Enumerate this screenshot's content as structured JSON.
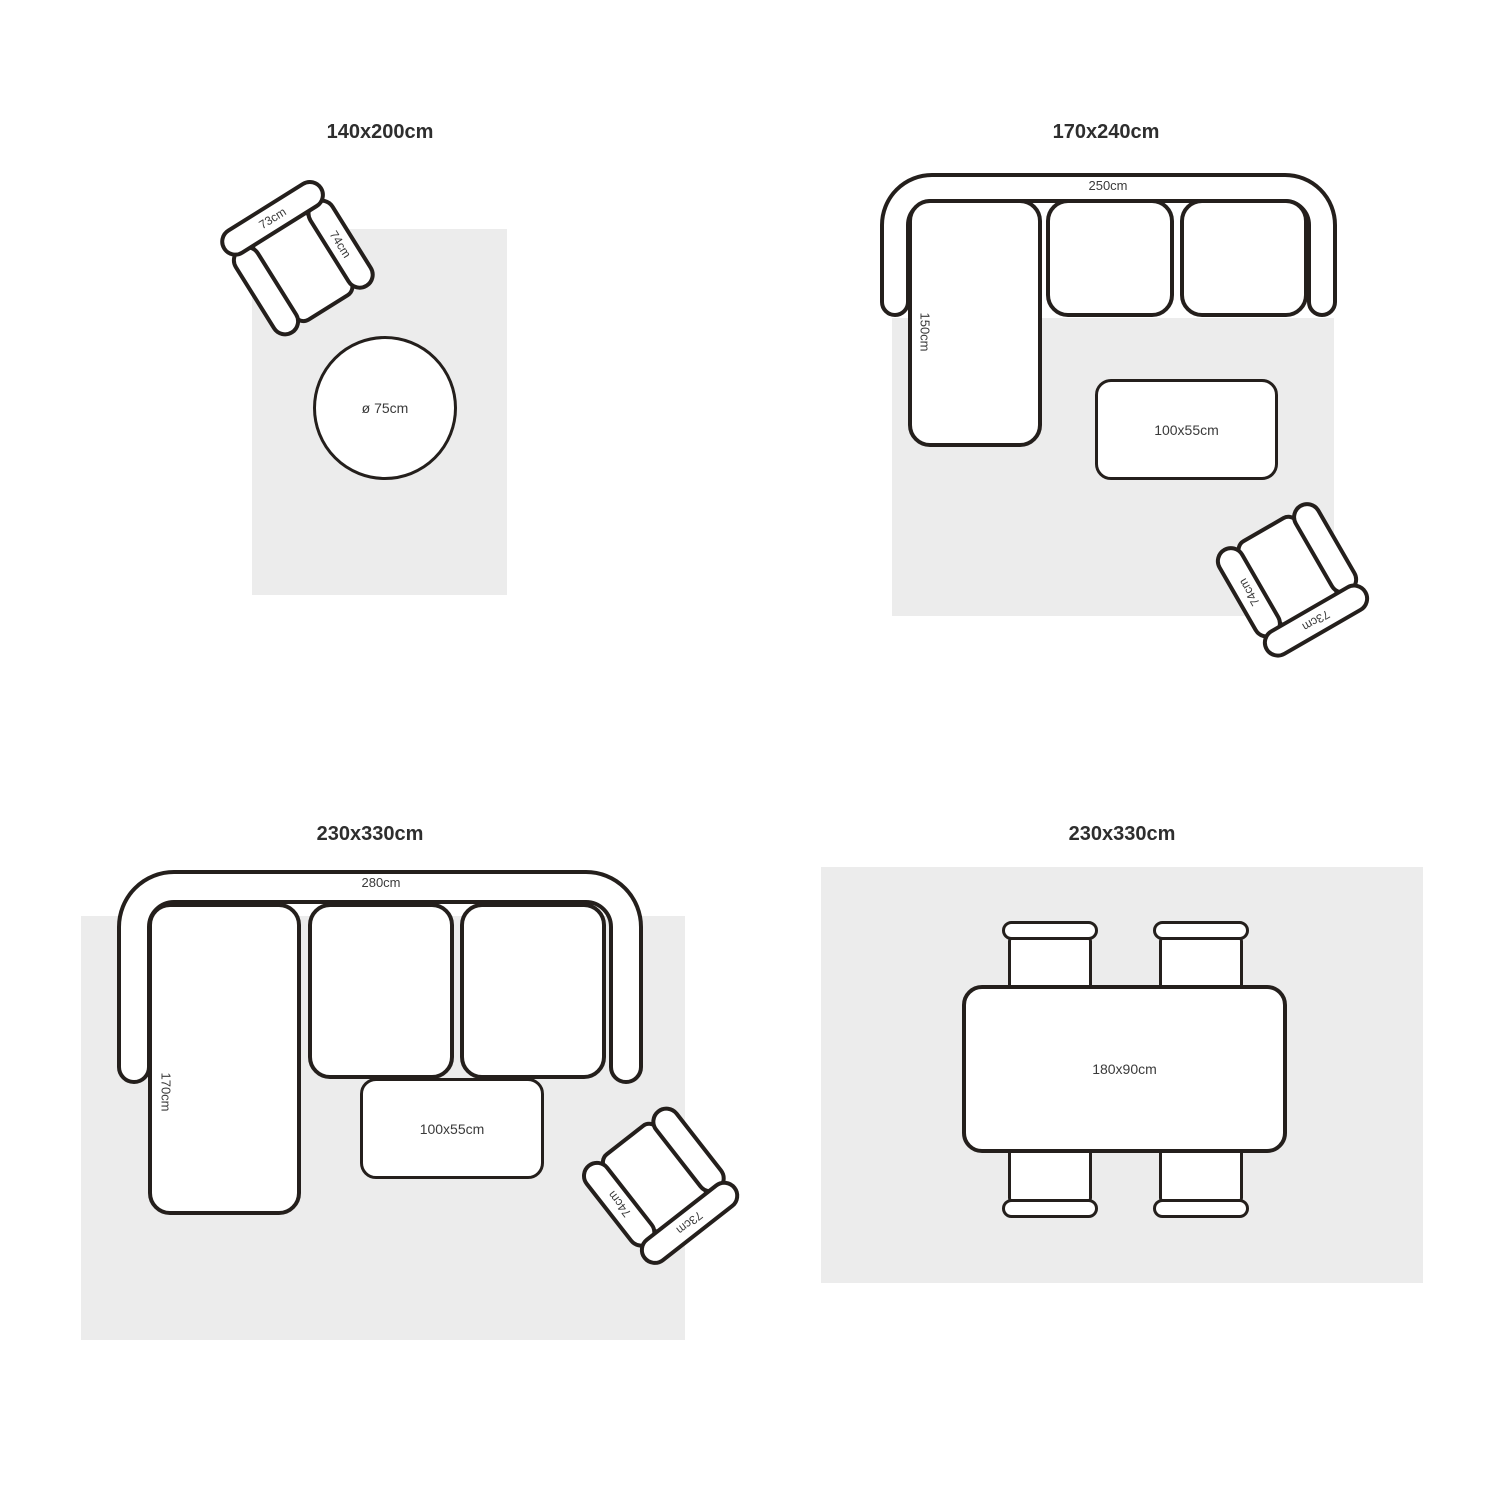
{
  "colors": {
    "background": "#ffffff",
    "outline": "#241f1c",
    "rug_fill": "#ececec",
    "label_text": "#3a3a3a",
    "title_text": "#2e2e2e"
  },
  "quadrants": {
    "top_left": {
      "title": "140x200cm",
      "armchair": {
        "back": "73cm",
        "arm": "74cm"
      },
      "round_table": "ø 75cm"
    },
    "top_right": {
      "title": "170x240cm",
      "sofa": {
        "width": "250cm",
        "depth": "150cm"
      },
      "coffee_table": "100x55cm",
      "armchair": {
        "back": "73cm",
        "arm": "74cm"
      }
    },
    "bottom_left": {
      "title": "230x330cm",
      "sofa": {
        "width": "280cm",
        "depth": "170cm"
      },
      "coffee_table": "100x55cm",
      "armchair": {
        "back": "73cm",
        "arm": "74cm"
      }
    },
    "bottom_right": {
      "title": "230x330cm",
      "dining_table": "180x90cm"
    }
  }
}
